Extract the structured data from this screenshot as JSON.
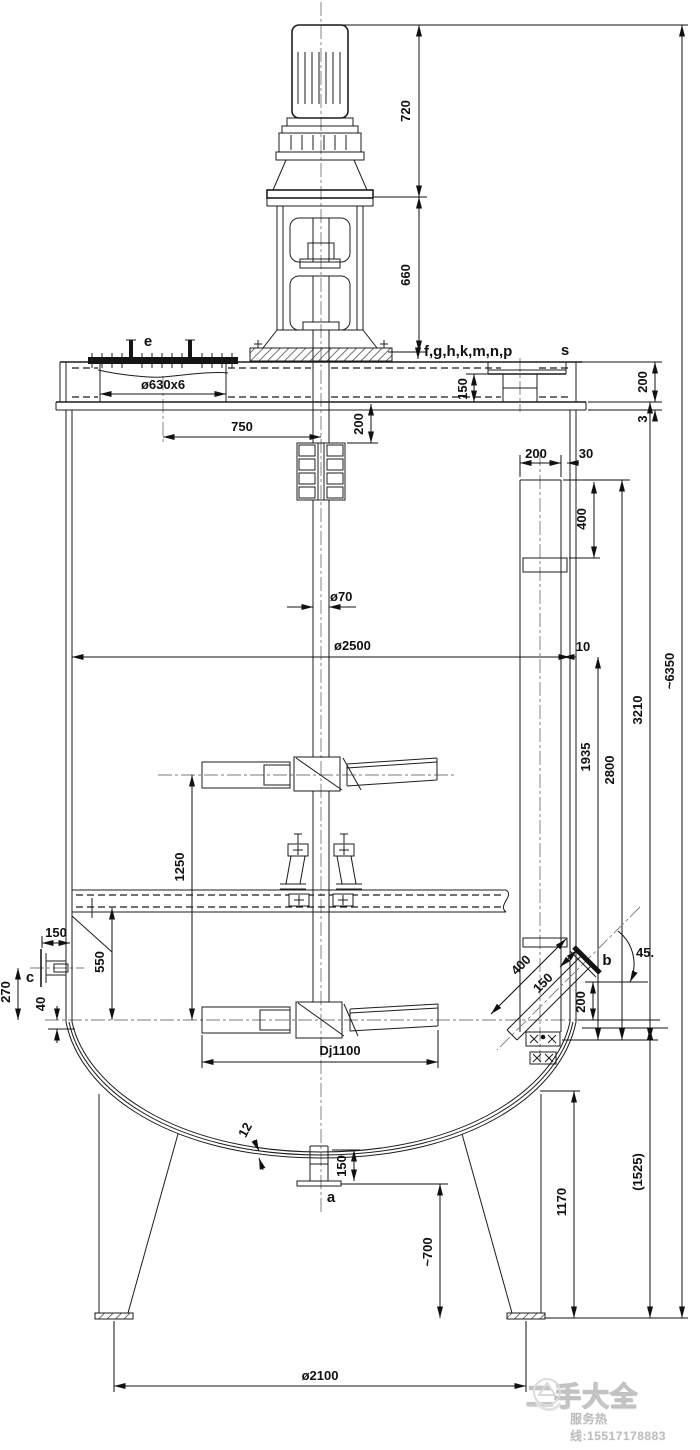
{
  "drawing": {
    "labels": {
      "top_nozzles": "f,g,h,k,m,n,p",
      "nozzle_s": "s",
      "nozzle_e": "e",
      "nozzle_a": "a",
      "nozzle_b": "b",
      "nozzle_c": "c",
      "manhole": "ø630x6",
      "impeller_code": "Dj1100"
    },
    "dims": {
      "motor": "720",
      "drive": "660",
      "overall": "~6350",
      "head200": "200",
      "head3": "3",
      "s150": "150",
      "stub200": "200",
      "mh750": "750",
      "pipe200": "200",
      "pipe30": "30",
      "pipe400": "400",
      "gap10": "10",
      "shaft70": "ø70",
      "tank2500": "ø2500",
      "d1935": "1935",
      "d2800": "2800",
      "d3210": "3210",
      "imp1250": "1250",
      "c150": "150",
      "c550": "550",
      "c270": "270",
      "c40": "40",
      "b400": "400",
      "b150": "150",
      "b200": "200",
      "b45": "45.",
      "thk12": "12",
      "a150": "150",
      "a700": "~700",
      "d1170": "1170",
      "d1525": "(1525)",
      "feet2100": "ø2100"
    },
    "watermark": {
      "name": "二手大全",
      "hotline": "服务热线:15517178883"
    }
  }
}
